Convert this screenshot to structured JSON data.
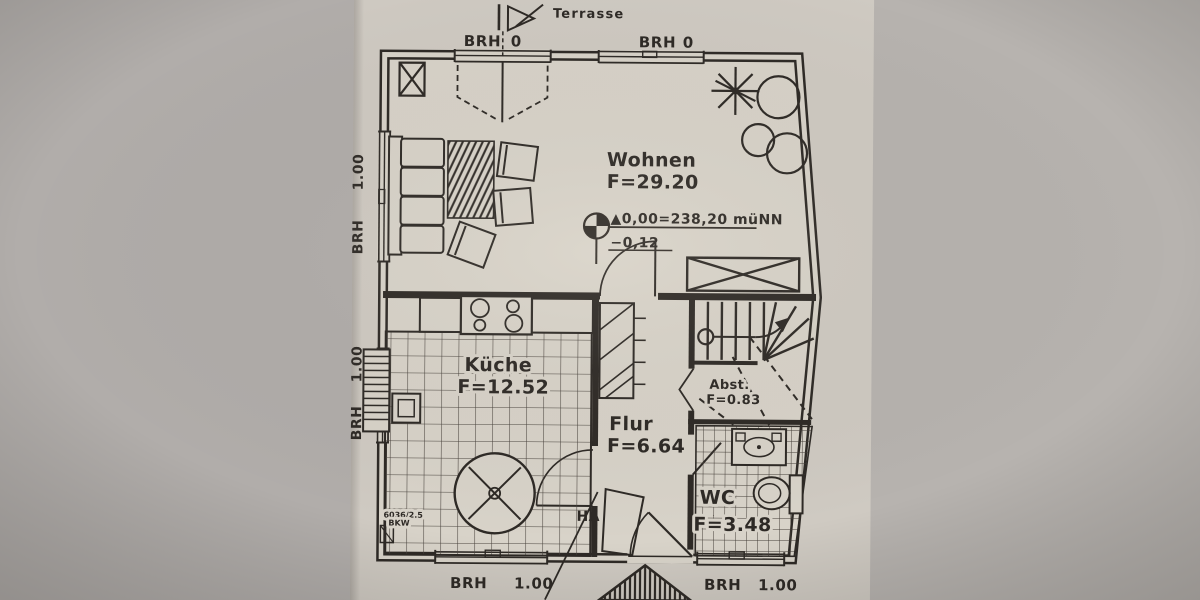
{
  "plan": {
    "terrasse": "Terrasse",
    "rooms": [
      {
        "name": "Wohnen",
        "area": "F=29.20"
      },
      {
        "name": "Küche",
        "area": "F=12.52"
      },
      {
        "name": "Flur",
        "area": "F=6.64"
      },
      {
        "name": "Abst.",
        "area": "F=0.83"
      },
      {
        "name": "WC",
        "area": "F=3.48"
      }
    ],
    "elevation": {
      "line1": "▲0,00=238,20 müNN",
      "line2": "−0,12"
    },
    "sills": {
      "top_left": {
        "label": "BRH",
        "value": "0"
      },
      "top_right": {
        "label": "BRH",
        "value": "0"
      },
      "left_upper": {
        "label": "BRH",
        "value": "1.00"
      },
      "left_lower": {
        "label": "BRH",
        "value": "1.00"
      },
      "bottom_left": {
        "label": "BRH",
        "value": "1.00"
      },
      "bottom_right": {
        "label": "BRH",
        "value": "1.00"
      }
    },
    "annotations": {
      "ha": "HA",
      "plot_line1": "6036/2.5",
      "plot_line2": "BKW"
    }
  },
  "colors": {
    "backdrop": "#b3afab",
    "paper": "#cfcac2",
    "floor": "#d8d3c9",
    "ink": "#2e2a26"
  }
}
